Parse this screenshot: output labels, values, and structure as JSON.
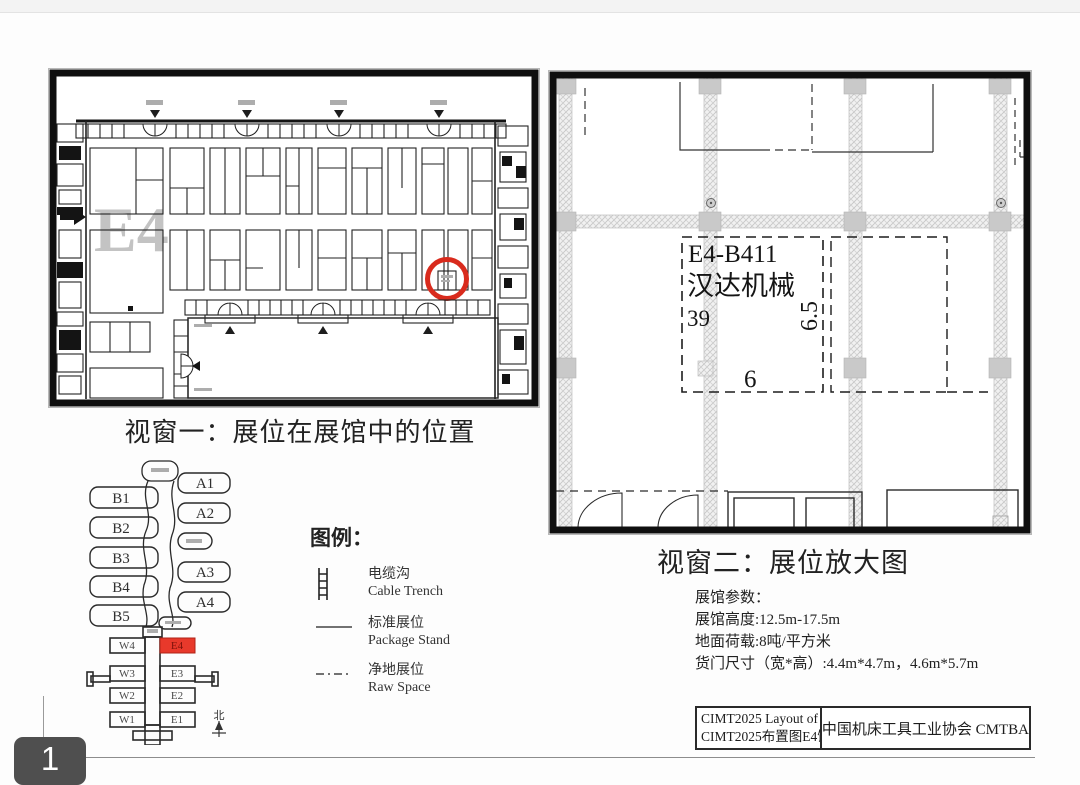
{
  "page": {
    "badge": "1"
  },
  "window1": {
    "title": "视窗一：展位在展馆中的位置",
    "hall_watermark": "E4",
    "overview": {
      "halls_left": [
        "B1",
        "B2",
        "B3",
        "B4",
        "B5"
      ],
      "halls_right": [
        "A1",
        "A2",
        "A3",
        "A4"
      ],
      "halls_west": [
        "W4",
        "W3",
        "W2",
        "W1"
      ],
      "halls_east": [
        "E4",
        "E3",
        "E2",
        "E1"
      ],
      "highlighted_hall": "E4",
      "compass_label": "北"
    }
  },
  "legend": {
    "title": "图例：",
    "items": [
      {
        "symbol": "cable-trench-icon",
        "label_cn": "电缆沟",
        "label_en": "Cable Trench"
      },
      {
        "symbol": "solid-line-icon",
        "label_cn": "标准展位",
        "label_en": "Package Stand"
      },
      {
        "symbol": "dash-dot-line-icon",
        "label_cn": "净地展位",
        "label_en": "Raw Space"
      }
    ]
  },
  "window2": {
    "title": "视窗二：展位放大图",
    "booth": {
      "id": "E4-B411",
      "name": "汉达机械",
      "area": "39",
      "depth": "6.5",
      "width": "6"
    },
    "params": {
      "heading": "展馆参数：",
      "lines": [
        "展馆高度:12.5m-17.5m",
        "地面荷载:8吨/平方米",
        "货门尺寸（宽*高）:4.4m*4.7m，4.6m*5.7m"
      ]
    }
  },
  "title_block": {
    "layout_en": "CIMT2025 Layout of E4",
    "layout_cn": "CIMT2025布置图E4馆",
    "association": "中国机床工具工业协会 CMTBA"
  },
  "colors": {
    "highlight_red": "#d92b1d",
    "hall_fill_red": "#e8392b"
  }
}
